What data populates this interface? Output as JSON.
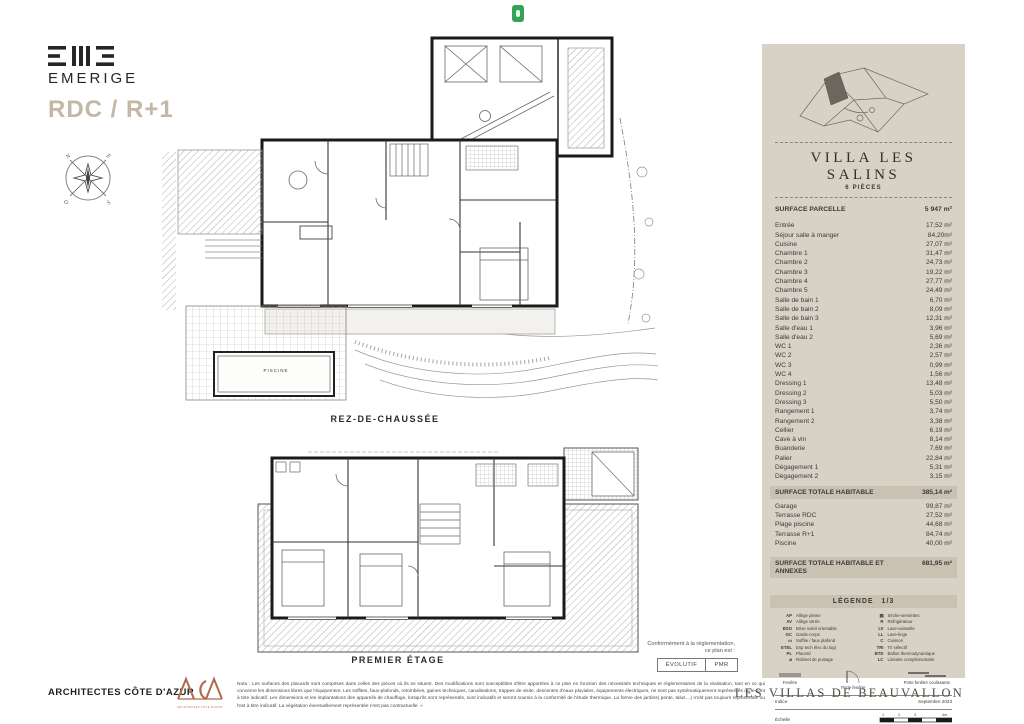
{
  "header": {
    "brand": "EMERIGE",
    "plan_title": "RDC / R+1",
    "compass": {
      "n": "N",
      "e": "E",
      "s": "S",
      "o": "O"
    }
  },
  "plans": {
    "rdc_label": "REZ-DE-CHAUSSÉE",
    "r1_label": "PREMIER ÉTAGE",
    "pool_label": "PISCINE"
  },
  "compliance": {
    "intro_line1": "Conformément à la réglementation,",
    "intro_line2": "ce plan est :",
    "buttons": [
      "ÉVOLUTIF",
      "PMR"
    ]
  },
  "panel": {
    "title": "VILLA LES SALINS",
    "subtitle": "6 PIÈCES",
    "parcel_label": "SURFACE PARCELLE",
    "parcel_value": "5 947 m²",
    "rooms": [
      {
        "label": "Entrée",
        "value": "17,52 m²"
      },
      {
        "label": "Séjour salle à manger",
        "value": "84,20m²"
      },
      {
        "label": "Cuisine",
        "value": "27,07 m²"
      },
      {
        "label": "Chambre 1",
        "value": "31,47 m²"
      },
      {
        "label": "Chambre 2",
        "value": "24,73 m²"
      },
      {
        "label": "Chambre 3",
        "value": "19,22 m²"
      },
      {
        "label": "Chambre 4",
        "value": "27,77 m²"
      },
      {
        "label": "Chambre 5",
        "value": "24,49 m²"
      },
      {
        "label": "Salle de bain 1",
        "value": "6,70 m²"
      },
      {
        "label": "Salle de bain 2",
        "value": "8,09 m²"
      },
      {
        "label": "Salle de bain 3",
        "value": "12,31 m²"
      },
      {
        "label": "Salle d'eau 1",
        "value": "3,96 m²"
      },
      {
        "label": "Salle d'eau 2",
        "value": "5,69 m²"
      },
      {
        "label": "WC 1",
        "value": "2,36 m²"
      },
      {
        "label": "WC 2",
        "value": "2,57 m²"
      },
      {
        "label": "WC 3",
        "value": "0,99 m²"
      },
      {
        "label": "WC 4",
        "value": "1,56 m²"
      },
      {
        "label": "Dressing 1",
        "value": "13,48 m²"
      },
      {
        "label": "Dressing 2",
        "value": "5,03 m²"
      },
      {
        "label": "Dressing 3",
        "value": "5,50 m²"
      },
      {
        "label": "Rangement 1",
        "value": "3,74 m²"
      },
      {
        "label": "Rangement 2",
        "value": "3,38 m²"
      },
      {
        "label": "Cellier",
        "value": "6,19 m²"
      },
      {
        "label": "Cave à vin",
        "value": "8,14 m²"
      },
      {
        "label": "Buanderie",
        "value": "7,69 m²"
      },
      {
        "label": "Palier",
        "value": "22,84 m²"
      },
      {
        "label": "Dégagement 1",
        "value": "5,31 m²"
      },
      {
        "label": "Dégagement 2",
        "value": "3,15 m²"
      }
    ],
    "total_habitable": {
      "label": "SURFACE TOTALE HABITABLE",
      "value": "385,14 m²"
    },
    "annexes": [
      {
        "label": "Garage",
        "value": "99,87 m²"
      },
      {
        "label": "Terrasse RDC",
        "value": "27,52 m²"
      },
      {
        "label": "Plage piscine",
        "value": "44,68 m²"
      },
      {
        "label": "Terrasse R+1",
        "value": "84,74 m²"
      },
      {
        "label": "Piscine",
        "value": "40,00 m²"
      }
    ],
    "total_all": {
      "label": "SURFACE TOTALE HABITABLE ET ANNEXES",
      "value": "681,95 m²"
    },
    "legend": {
      "title": "LÉGENDE",
      "page": "1/3",
      "left": [
        {
          "abbr": "AP",
          "label": "Allège pleine"
        },
        {
          "abbr": "AV",
          "label": "Allège vitrée"
        },
        {
          "abbr": "BSO",
          "label": "Brise soleil orientable"
        },
        {
          "abbr": "GC",
          "label": "Garde-corps"
        },
        {
          "abbr": "▭",
          "label": "Soffite / faux plafond"
        },
        {
          "abbr": "ETEL",
          "label": "Esp tech élec du logt"
        },
        {
          "abbr": "PL",
          "label": "Placard"
        },
        {
          "abbr": "⌀",
          "label": "Robinet de puisage"
        }
      ],
      "right": [
        {
          "abbr": "▤",
          "label": "Sèche-serviettes"
        },
        {
          "abbr": "R",
          "label": "Réfrigérateur"
        },
        {
          "abbr": "LV",
          "label": "Lave-vaisselle"
        },
        {
          "abbr": "LL",
          "label": "Lave-linge"
        },
        {
          "abbr": "C",
          "label": "Cuisson"
        },
        {
          "abbr": "TRI",
          "label": "Tri sélectif"
        },
        {
          "abbr": "BTD",
          "label": "Ballon thermodynamique"
        },
        {
          "abbr": "LC",
          "label": "Linéaire complémentaire"
        }
      ],
      "openings": [
        "Fenêtre",
        "Porte fenêtre",
        "Porte fenêtre coulissante"
      ],
      "indice_label": "Indice",
      "indice_value": "Septembre 2023",
      "echelle_label": "Échelle",
      "scale_ticks": [
        "1",
        "2",
        "3",
        "4m"
      ]
    }
  },
  "footer": {
    "architect": "ARCHITECTES CÔTE D'AZUR",
    "aca": "ACA",
    "aca_sub": "ARCHITECTES CÔTE D'AZUR",
    "note": "Nota : Les surfaces des placards sont comprises dans celles des pièces où ils se situent. Des modifications sont susceptibles d'être apportées à ce plan en fonction des nécessités techniques et réglementaires de la réalisation, tant en ce qui concerne les dimensions libres que l'équipement. Les soffites, faux-plafonds, retombées, gaines techniques, canalisations, trappes de visite, descentes d'eaux pluviales, équipements électriques, ne sont pas systématiquement représentés ou le sont à titre indicatif. Les dimensions et les implantations des appareils de chauffage, lorsqu'ils sont représentés, sont indicatifs et seront soumis à la conformité de l'étude thermique. La forme des jardins( pente, talus…) n'est pas toujours représentée ou l'est à titre indicatif. La végétation éventuellement représentée n'est pas contractuelle. »",
    "project": "LES VILLAS DE BEAUVALLON"
  },
  "colors": {
    "panel_bg": "#d8d2c6",
    "band_bg": "#c9c1b2",
    "title_beige": "#c3b8a5",
    "brand_ink": "#262626",
    "aca_brown": "#b06a4d",
    "badge_green": "#35a257",
    "wall_ink": "#1a1a1a"
  }
}
